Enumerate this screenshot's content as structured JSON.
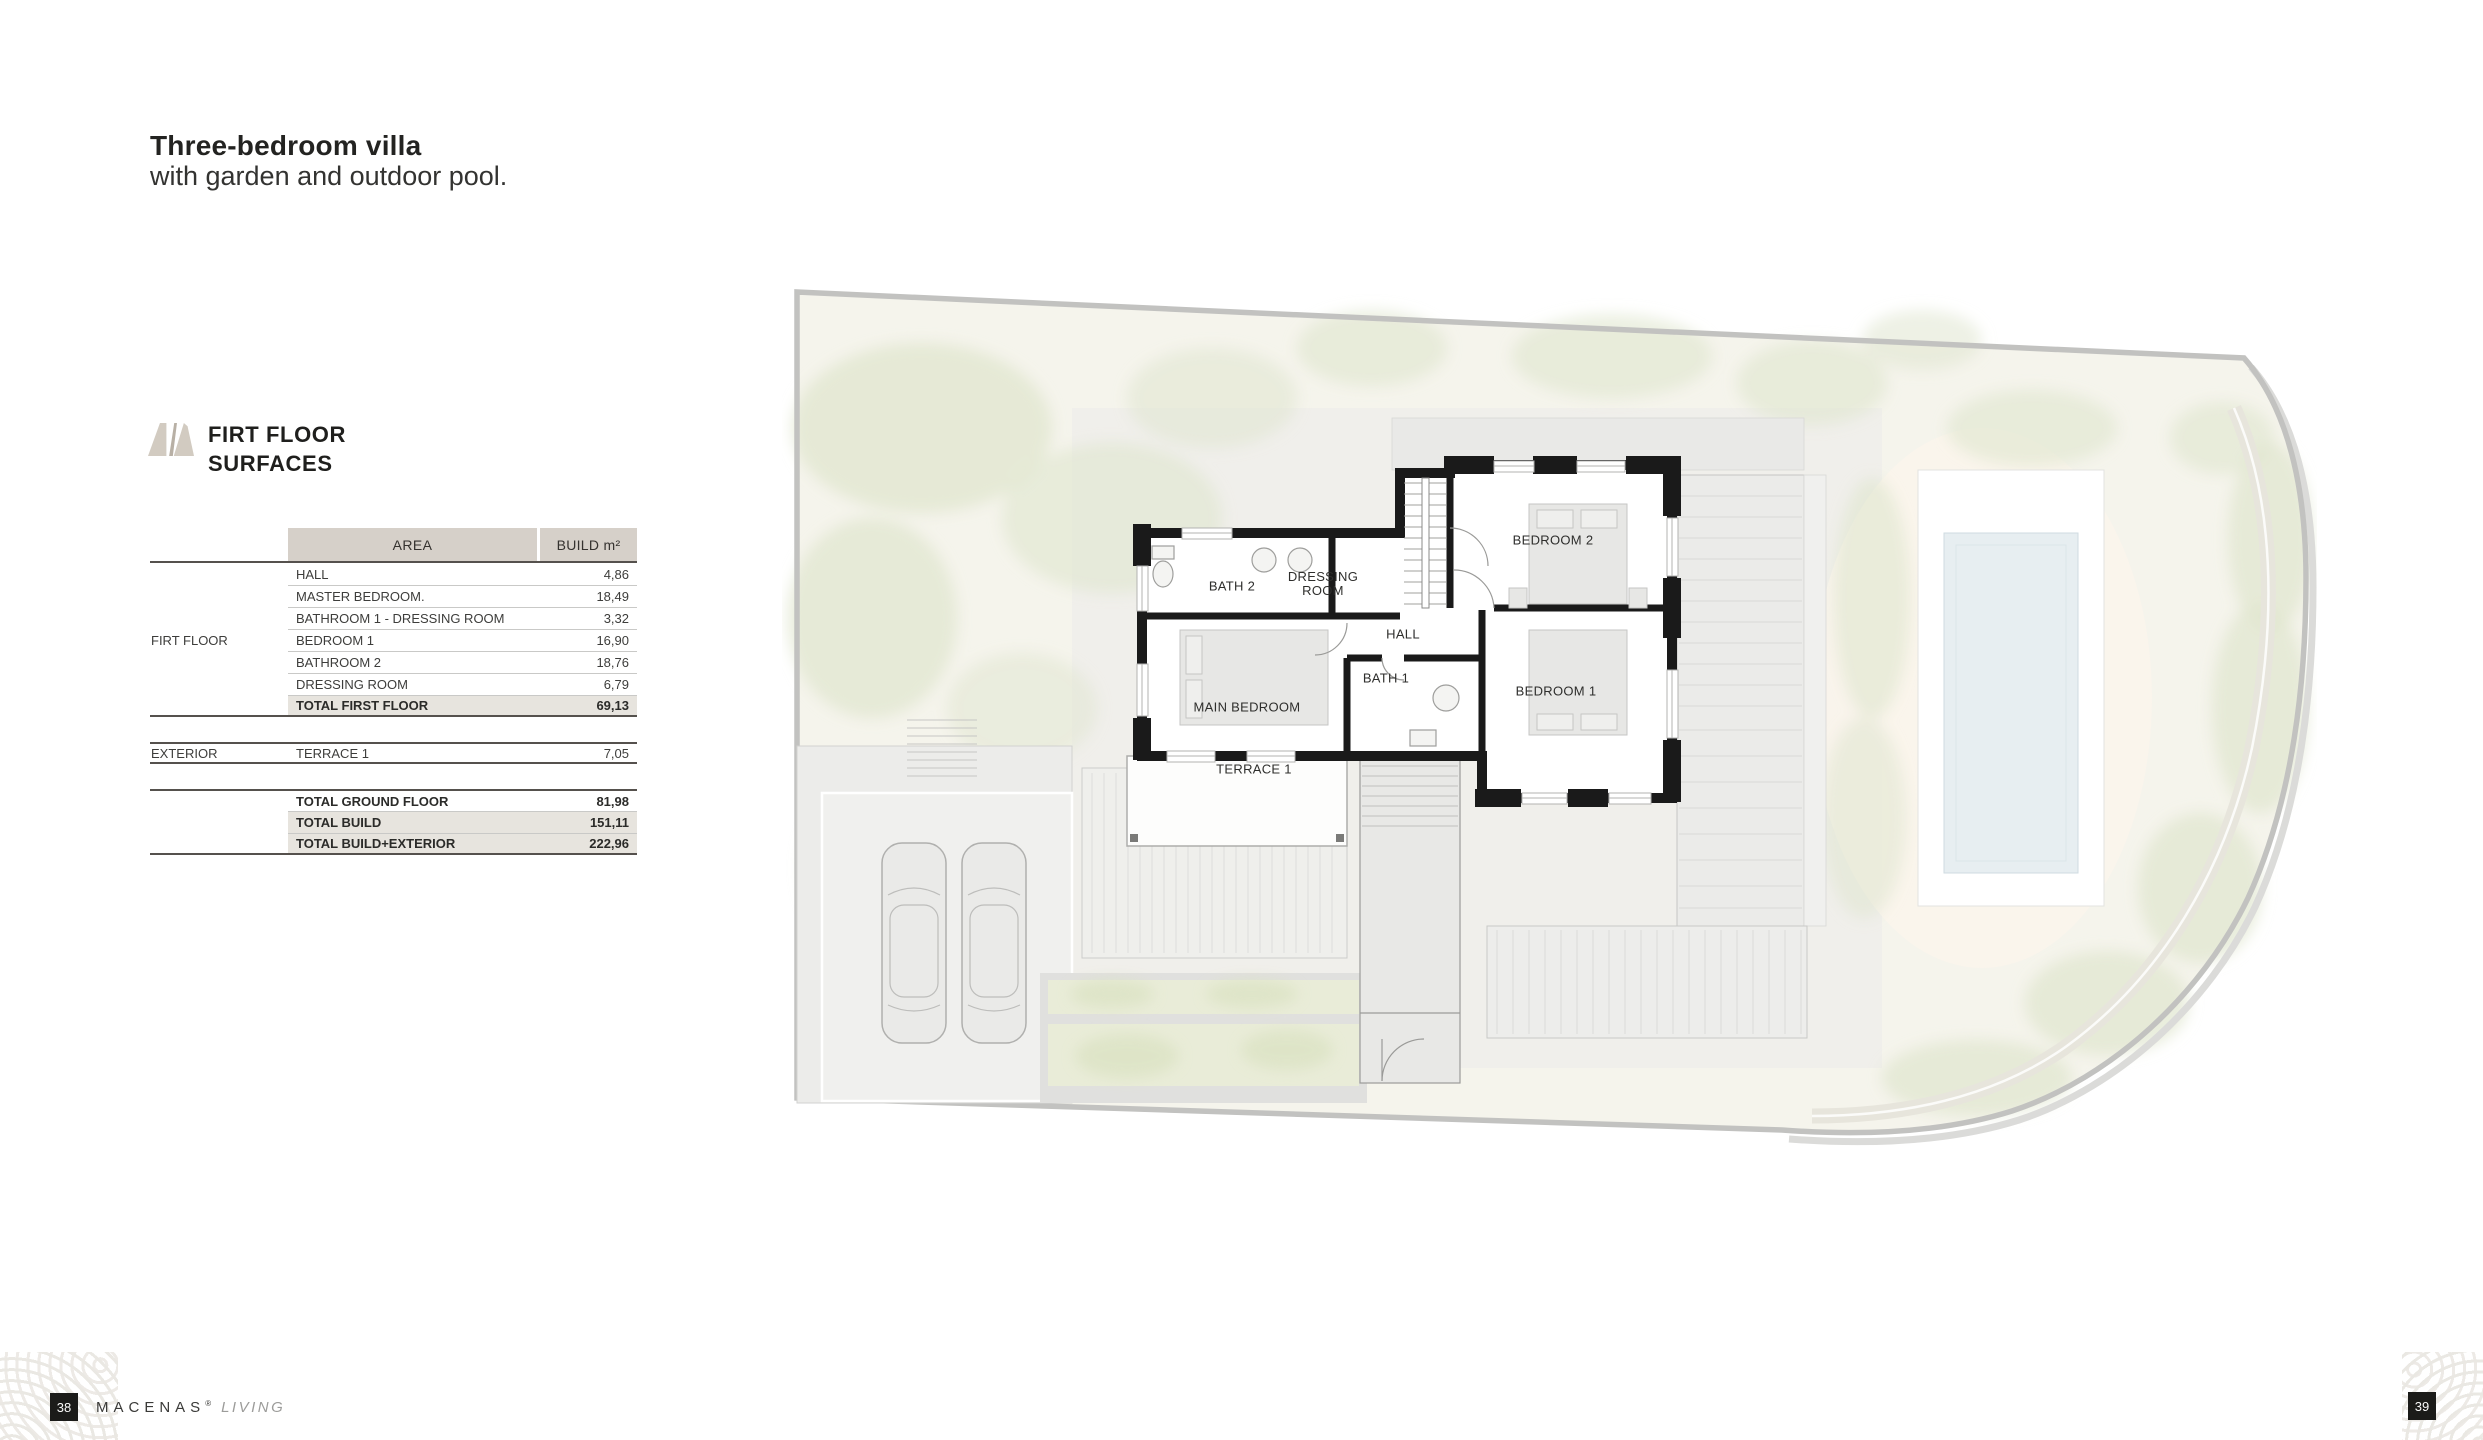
{
  "header": {
    "title": "Three-bedroom villa",
    "subtitle": "with garden and outdoor pool."
  },
  "section": {
    "heading_line1": "FIRT FLOOR",
    "heading_line2": "SURFACES"
  },
  "surfaces": {
    "columns": {
      "area": "AREA",
      "build": "BUILD m²"
    },
    "rows": [
      {
        "area": "HALL",
        "value": "4,86"
      },
      {
        "area": "MASTER BEDROOM.",
        "value": "18,49"
      },
      {
        "area": "BATHROOM 1 - DRESSING ROOM",
        "value": "3,32"
      },
      {
        "area": "BEDROOM 1",
        "value": "16,90",
        "group": "FIRT FLOOR"
      },
      {
        "area": "BATHROOM 2",
        "value": "18,76"
      },
      {
        "area": "DRESSING ROOM",
        "value": "6,79"
      },
      {
        "area": "TOTAL FIRST FLOOR",
        "value": "69,13",
        "bold": true,
        "shaded": true,
        "rule_below": "dark"
      },
      {
        "spacer": true
      },
      {
        "area": "TERRACE 1",
        "value": "7,05",
        "group": "EXTERIOR",
        "rule_above": "dark",
        "rule_below": "dark"
      },
      {
        "spacer": true
      },
      {
        "area": "TOTAL GROUND FLOOR",
        "value": "81,98",
        "bold": true,
        "rule_above": "dark"
      },
      {
        "area": "TOTAL BUILD",
        "value": "151,11",
        "bold": true,
        "shaded": true
      },
      {
        "area": "TOTAL BUILD+EXTERIOR",
        "value": "222,96",
        "bold": true,
        "shaded": true,
        "rule_below": "dark"
      }
    ]
  },
  "floorplan": {
    "labels": {
      "bath2": "BATH 2",
      "dressing_line1": "DRESSING",
      "dressing_line2": "ROOM",
      "hall": "HALL",
      "bath1": "BATH 1",
      "main_bedroom": "MAIN BEDROOM",
      "bedroom2": "BEDROOM 2",
      "bedroom1": "BEDROOM 1",
      "terrace1": "TERRACE 1"
    }
  },
  "footer": {
    "page_left": "38",
    "page_right": "39",
    "brand": "MACENAS",
    "trademark": "®",
    "brand_suffix": "LIVING"
  },
  "colors": {
    "table_header_bg": "#d6d0c9",
    "table_shaded_bg": "#e7e4de",
    "wall": "#1a1a1a",
    "pool_water": "#e7eef1",
    "garden": "#f5f4ec",
    "foliage": "#e3e8d3",
    "boundary": "#c2c2c0"
  }
}
